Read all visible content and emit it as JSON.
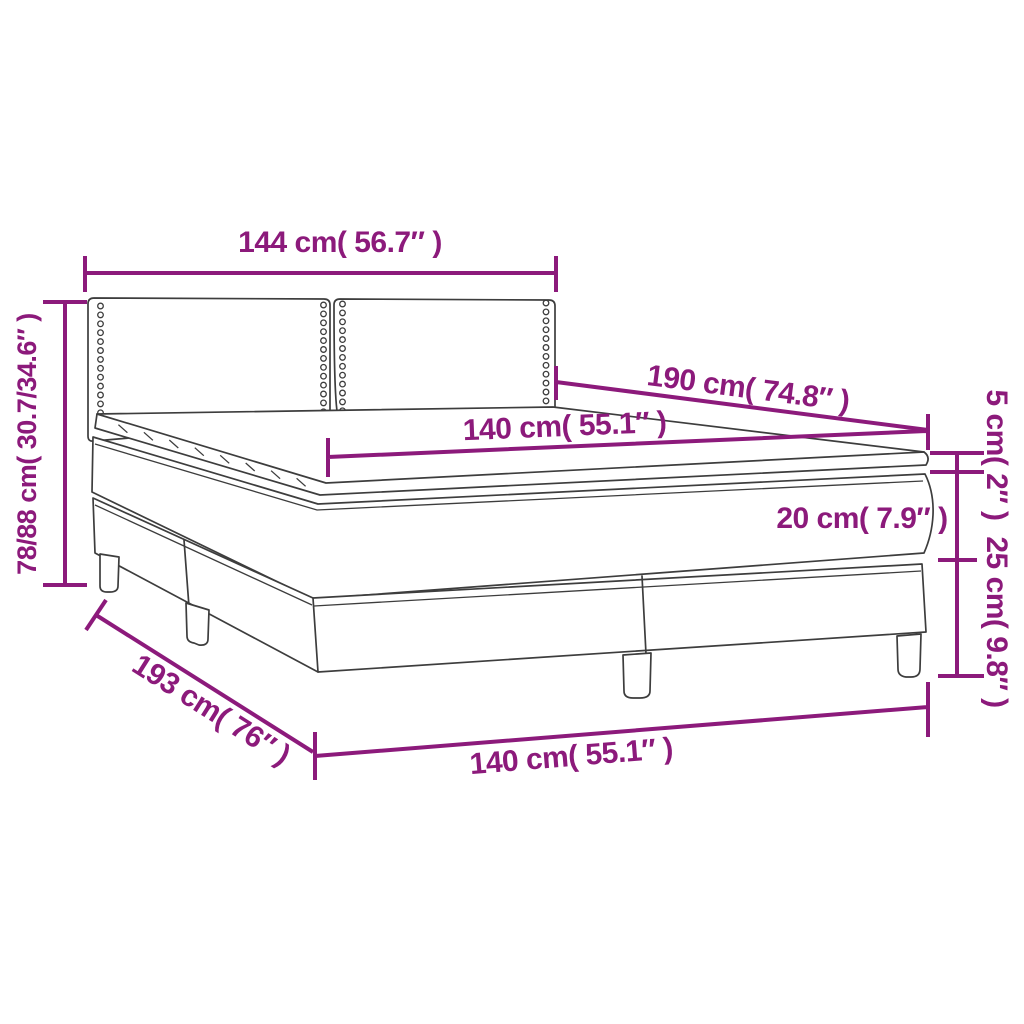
{
  "diagram": {
    "type": "product-dimension-diagram",
    "subject": "box-spring-bed-with-headboard-and-topper",
    "labels": {
      "headboard_width": "144 cm( 56.7″ )",
      "bed_length": "190 cm( 74.8″ )",
      "mattress_width": "140 cm( 55.1″ )",
      "topper_thickness": "5 cm( 2″ )",
      "mattress_thickness": "20 cm( 7.9″ )",
      "base_height": "25 cm( 9.8″ )",
      "headboard_height": "78/88 cm( 30.7/34.6″ )",
      "base_length": "193 cm( 76″ )",
      "base_width": "140 cm( 55.1″ )"
    },
    "colors": {
      "dimension": "#8c1a7b",
      "artwork": "#3d3d3d",
      "background": "#ffffff"
    }
  }
}
